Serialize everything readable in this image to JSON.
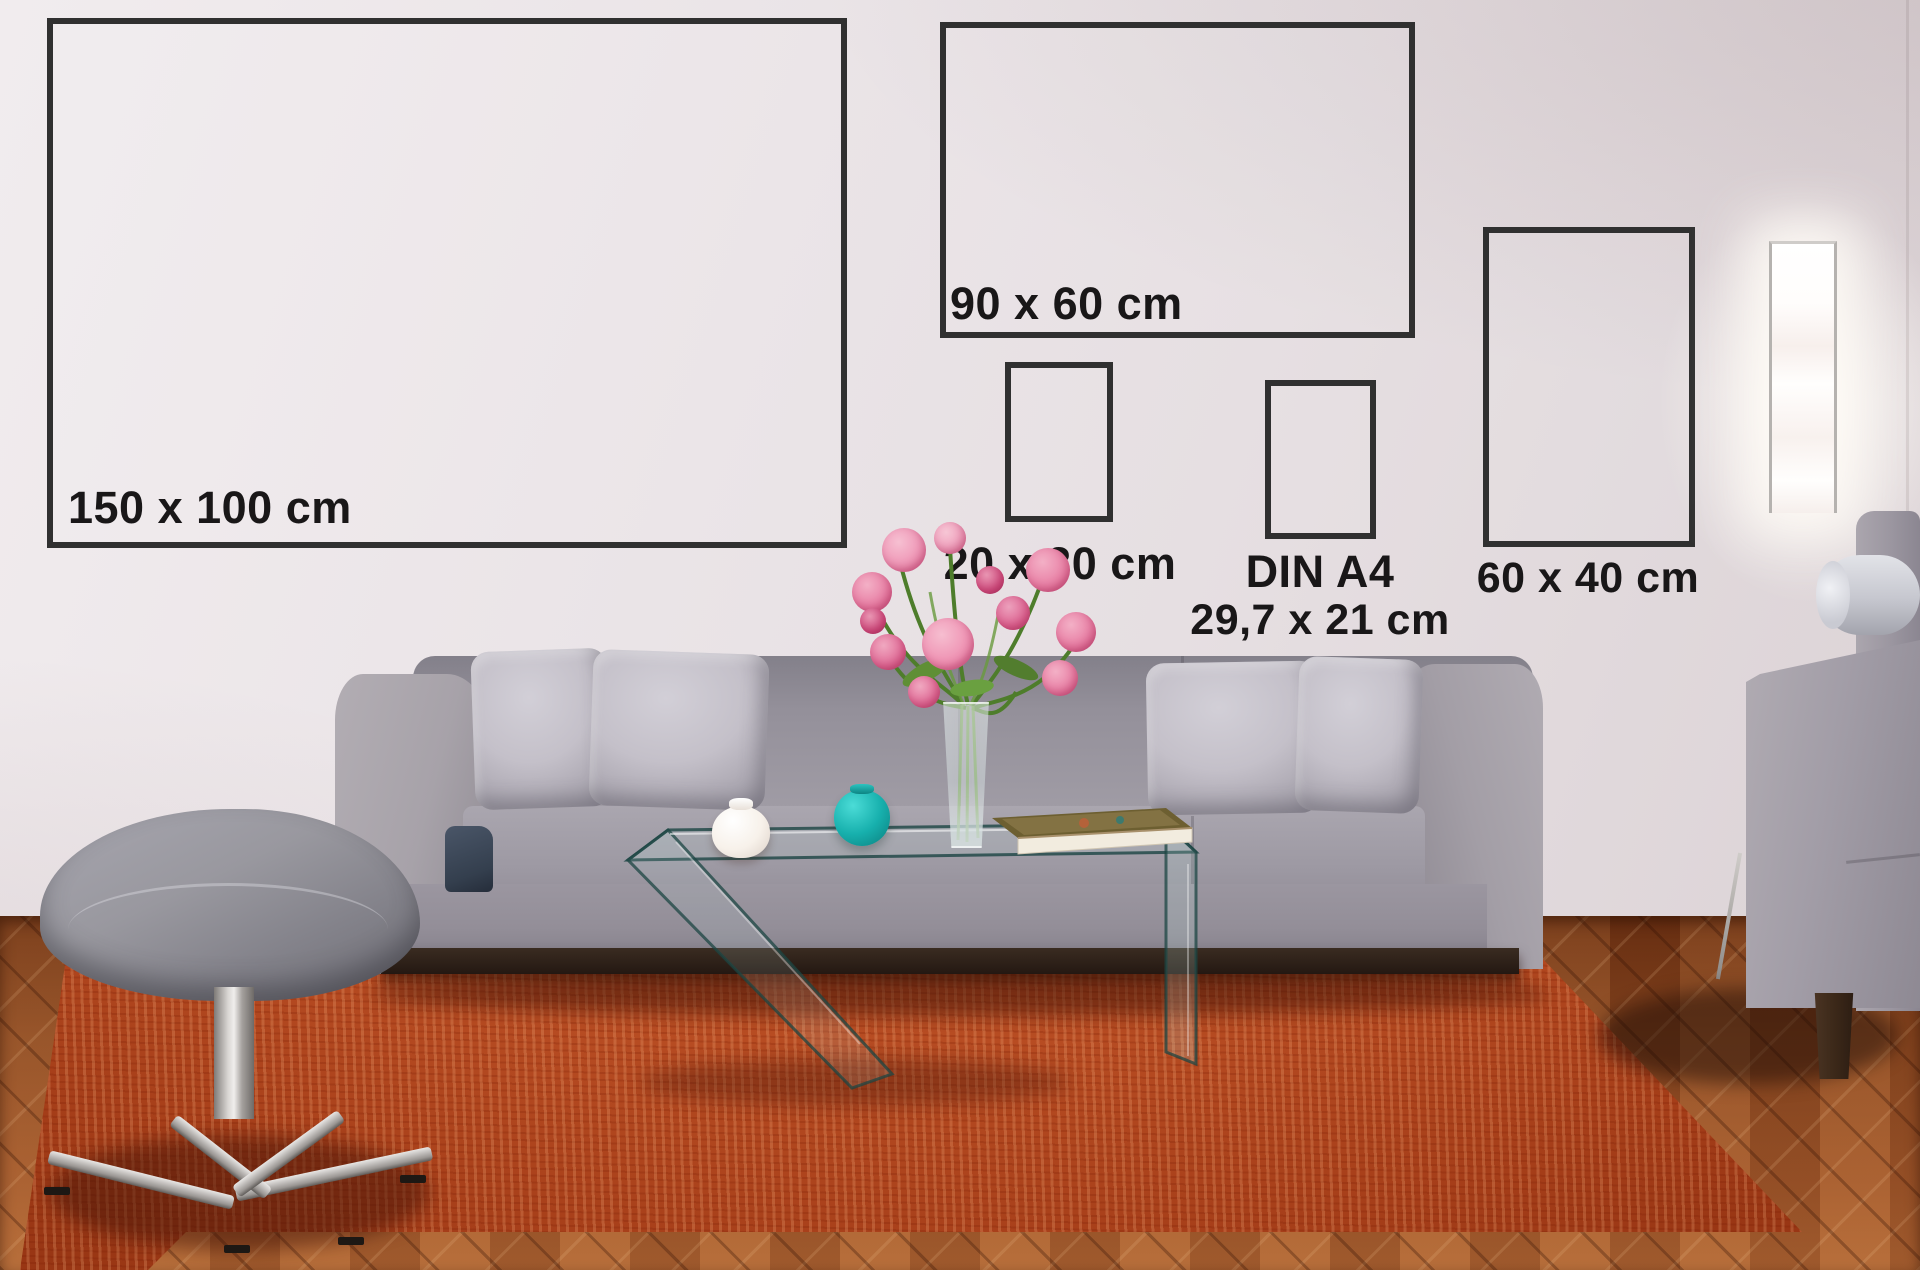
{
  "size_chart": {
    "frames": [
      {
        "id": "150x100",
        "label": "150 x 100 cm"
      },
      {
        "id": "90x60",
        "label": "90 x 60 cm"
      },
      {
        "id": "20x30",
        "label": "20 x 30 cm"
      },
      {
        "id": "din-a4",
        "label": "DIN A4",
        "sublabel": "29,7 x 21 cm"
      },
      {
        "id": "60x40",
        "label": "60 x 40 cm"
      }
    ],
    "label_text_color": "#191718",
    "frame_border_color": "#303030"
  },
  "scene_colors": {
    "wall": "#e9e3e6",
    "floor_wood": "#8d4a22",
    "rug": "#c05327",
    "sofa_fabric": "#a19da7",
    "pillow": "#c9c5cd",
    "sofa_plinth": "#2e231b",
    "ottoman_fabric": "#8f8e97",
    "chrome": "#d8d5d2",
    "flower_pink": "#e77ba2",
    "leaf_green": "#5a8a33",
    "teal_vase": "#17b0ad",
    "white_vase": "#f7f2ec",
    "book_cover": "#6d5f31",
    "book_pages": "#f2ecdf",
    "glass_edge": "#1c4543",
    "lamp_glow": "#fffefb",
    "navy_throw": "#343f4e"
  }
}
